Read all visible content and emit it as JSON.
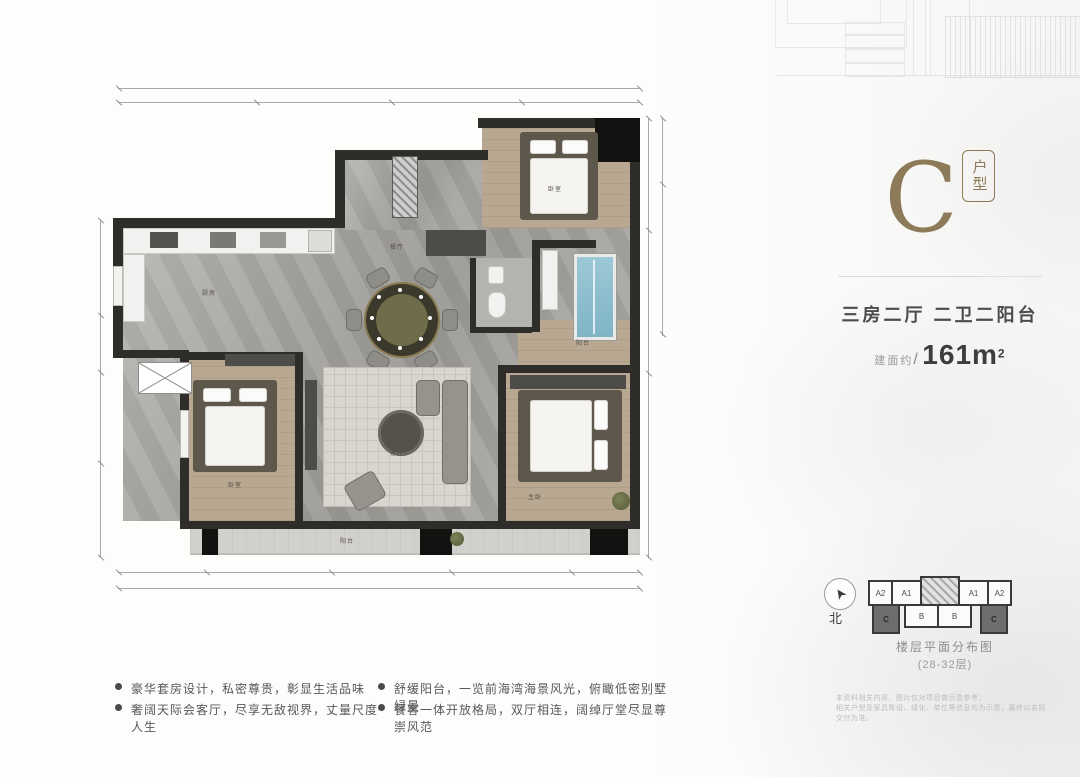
{
  "unit_card": {
    "letter": "C",
    "type_badge": "户型",
    "spec": "三房二厅 二卫二阳台",
    "area_prefix": "建面约",
    "area_slash": "/",
    "area_value": "161m",
    "area_sup": "2",
    "accent_color": "#8d7a58"
  },
  "floor_plan": {
    "room_labels": [
      {
        "label": "厨房"
      },
      {
        "label": "餐厅"
      },
      {
        "label": "客厅"
      },
      {
        "label": "卧室"
      },
      {
        "label": "卧室"
      },
      {
        "label": "主卧"
      },
      {
        "label": "阳台"
      },
      {
        "label": "阳台"
      }
    ]
  },
  "stack_diagram": {
    "compass_label": "北",
    "top_units": [
      "A2",
      "A1",
      "A1",
      "A2"
    ],
    "bottom_units": [
      "C",
      "B",
      "B",
      "C"
    ],
    "highlight_unit": "C",
    "caption_line1": "楼层平面分布图",
    "caption_line2": "(28-32层)"
  },
  "highlights": [
    {
      "text": "豪华套房设计，私密尊贵，彰显生活品味"
    },
    {
      "text": "奢阔天际会客厅，尽享无敌视界，丈量尺度人生"
    },
    {
      "text": "舒缓阳台，一览前海湾海景风光，俯瞰低密别墅绿景"
    },
    {
      "text": "餐客一体开放格局，双厅相连，阔绰厅堂尽显尊崇风范"
    }
  ],
  "disclaimer": {
    "line1": "本资料相关内容、图片仅对项目做示意参考；",
    "line2": "相关户型及家具陈设、绿化、单位等信息均为示意，最终以实际交付为准。"
  }
}
